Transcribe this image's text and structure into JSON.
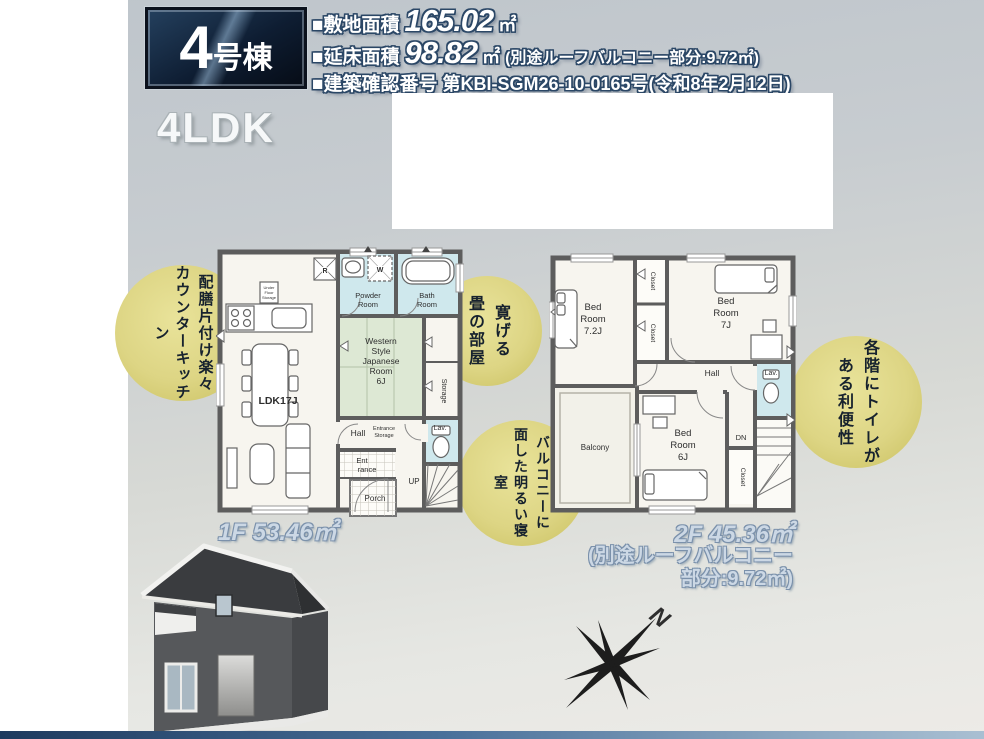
{
  "badge": {
    "number": "4",
    "suffix": "号棟"
  },
  "specs": [
    {
      "label": "■敷地面積",
      "value": "165.02",
      "unit": "㎡",
      "note": ""
    },
    {
      "label": "■延床面積",
      "value": "98.82",
      "unit": "㎡",
      "note": "(別途ルーフバルコニー部分:9.72㎡)"
    },
    {
      "label": "■建築確認番号",
      "value": "第KBI-SGM26-10-0165号(令和8年2月12日)"
    }
  ],
  "layout_type": "4LDK",
  "callouts": [
    {
      "lines": [
        "配膳片付け楽々",
        "カウンターキッチン"
      ]
    },
    {
      "lines": [
        "寛げる",
        "畳の部屋"
      ]
    },
    {
      "lines": [
        "バルコニーに",
        "面した明るい寝室"
      ]
    },
    {
      "lines": [
        "各階にトイレが",
        "ある利便性"
      ]
    }
  ],
  "floor1": {
    "area_label": "1F 53.46㎡",
    "ldk": "LDK17J",
    "fridge": "R",
    "washer": "W",
    "powder": [
      "Powder",
      "Room"
    ],
    "bath": [
      "Bath",
      "Room"
    ],
    "tatami": [
      "Western",
      "Style",
      "Japanese",
      "Room",
      "6J"
    ],
    "under_floor": [
      "Under",
      "Floor",
      "Storage"
    ],
    "storage": "Storage",
    "lav": "Lav.",
    "hall": "Hall",
    "entrance_storage": [
      "Entrance",
      "Storage"
    ],
    "entrance": [
      "Ent",
      "rance"
    ],
    "porch": "Porch",
    "up": "UP"
  },
  "floor2": {
    "area_label": "2F 45.36㎡",
    "roof_note": [
      "(別途ルーフバルコニー",
      "部分:9.72㎡)"
    ],
    "bed72": [
      "Bed",
      "Room",
      "7.2J"
    ],
    "bed7": [
      "Bed",
      "Room",
      "7J"
    ],
    "bed6": [
      "Bed",
      "Room",
      "6J"
    ],
    "closet": "Closet",
    "hall": "Hall",
    "lav": "Lav.",
    "dn": "DN",
    "balcony": "Balcony"
  },
  "compass": {
    "north": "N"
  },
  "colors": {
    "callout_bg": "#ddd584",
    "wet_room": "#cfe8ed",
    "tatami_green": "#dde8d4",
    "wall_gray": "#5d5d5d",
    "header_outline": "#2b4766",
    "floor_label_blue": "#ccd8e5"
  }
}
